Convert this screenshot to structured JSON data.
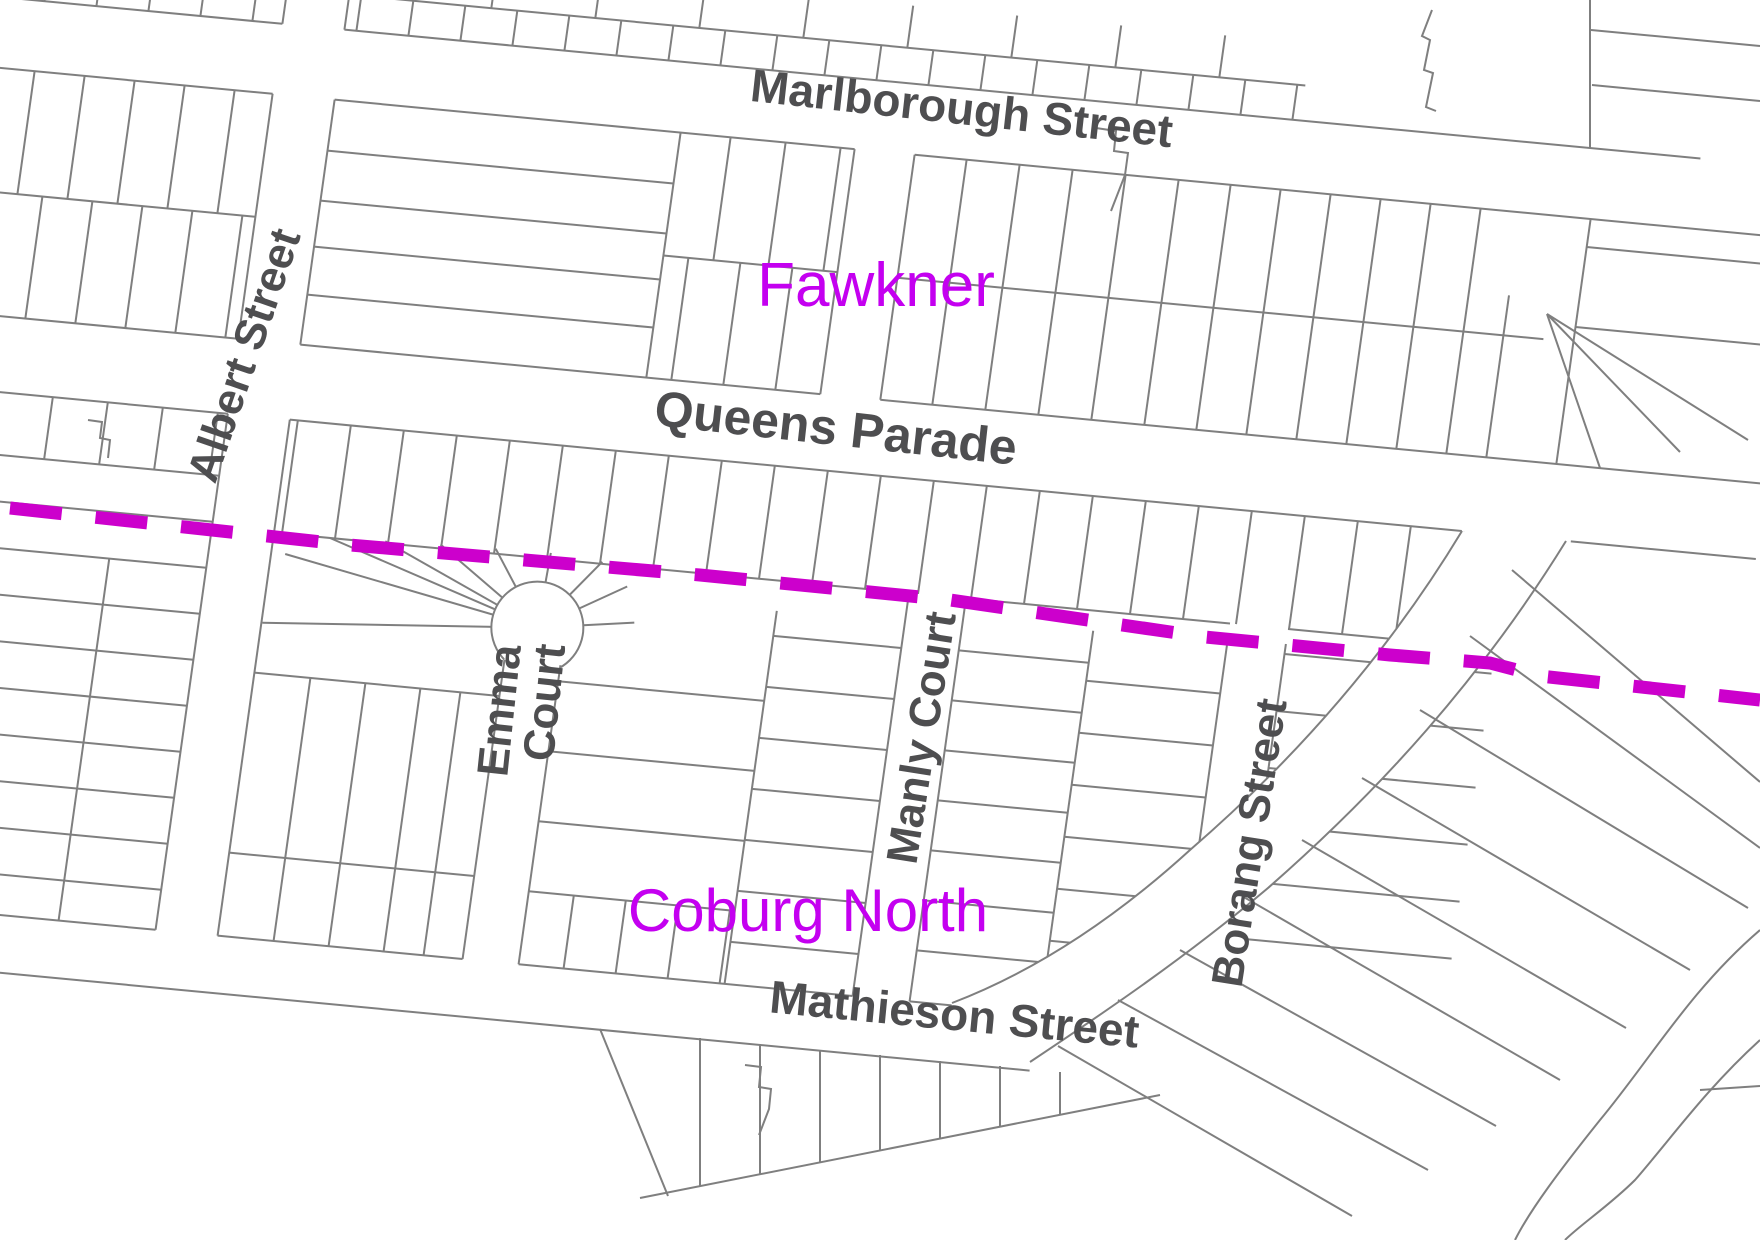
{
  "map": {
    "background": "#ffffff",
    "parcel_line_color": "#7f7f7f",
    "street_label_color": "#4e4e50",
    "suburb_label_color": "#c400f0",
    "boundary_color": "#cc00cc",
    "labels": {
      "marlborough": "Marlborough Street",
      "queens": "Queens Parade",
      "mathieson": "Mathieson Street",
      "albert": "Albert Street",
      "emma_line1": "Emma",
      "emma_line2": "Court",
      "manly": "Manly Court",
      "borang": "Borang Street",
      "suburb_north": "Fawkner",
      "suburb_south": "Coburg North"
    }
  }
}
